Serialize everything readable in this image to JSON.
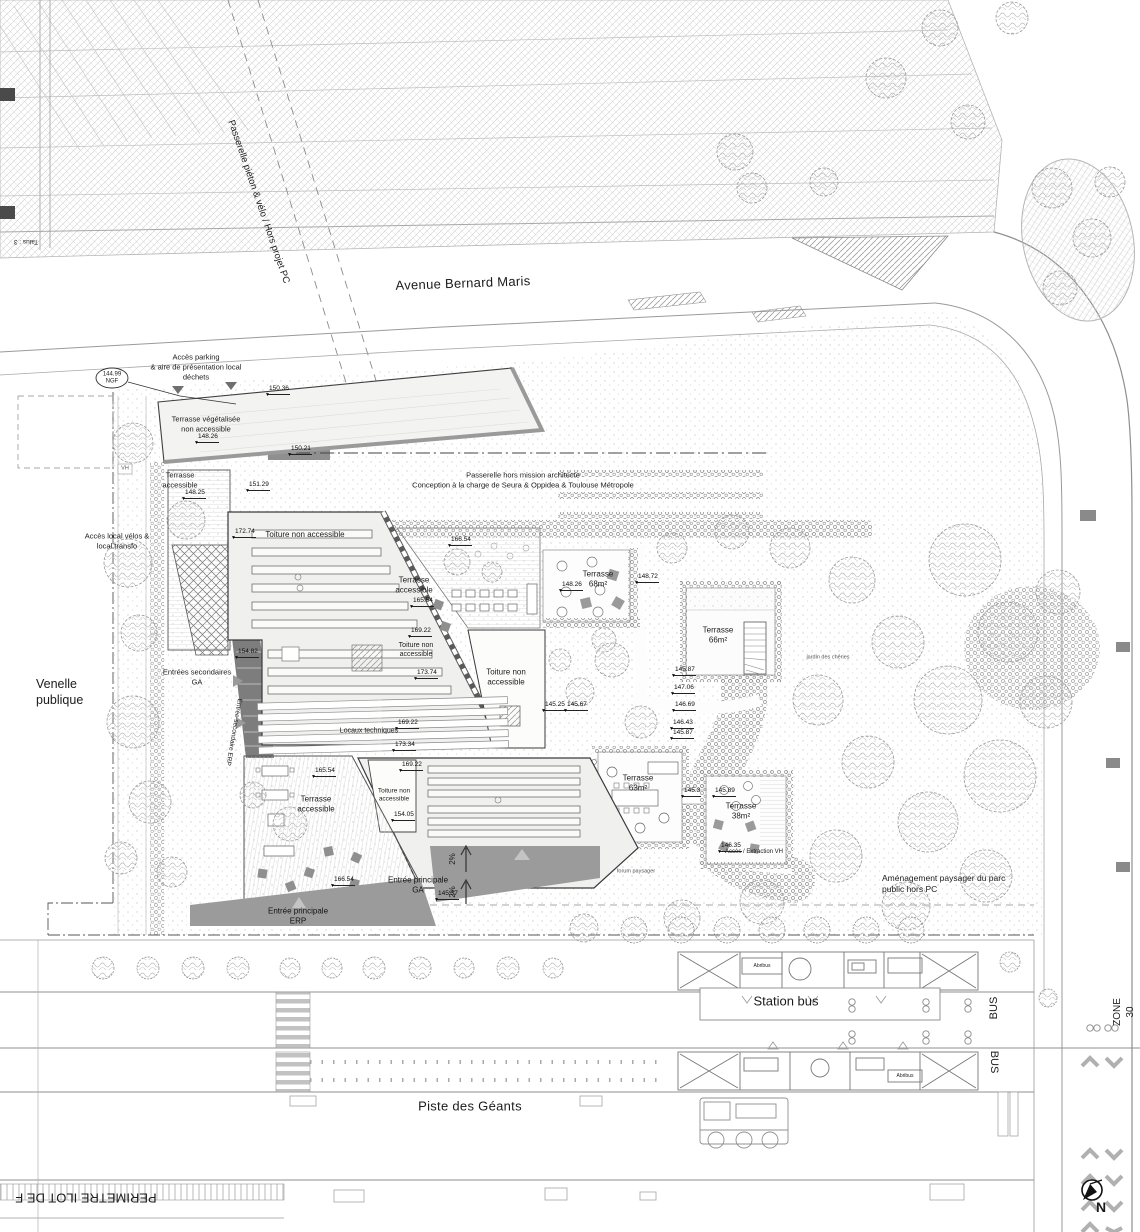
{
  "plan": {
    "streets": {
      "avenue": "Avenue Bernard Maris",
      "piste": "Piste des Géants",
      "venelle": "Venelle\npublique",
      "zone30": "ZONE 30",
      "bus1": "BUS",
      "bus2": "BUS",
      "station_bus": "Station bus",
      "talus": "Talus : 3"
    },
    "annotations": {
      "passerelle_pieton": "Passerelle piéton & vélo / Hors projet PC",
      "acces_parking": "Accès parking\n& aire de présentation local\ndéchets",
      "ngf": "144.99\nNGF",
      "passerelle_mission": "Passerelle hors mission architecte\nConception à la charge de Seura & Oppidea & Toulouse Métropole",
      "acces_velos": "Accès local vélos &\nlocal transfo",
      "amenagement": "Aménagement paysager du parc\npublic hors PC",
      "perimetre": "PERIMETRE ILOT DE F",
      "jardin": "jardin des chênes",
      "forum": "forum paysager",
      "acces_vh": "Accès / Extraction VH",
      "vh": "VH",
      "north": "N",
      "slope1": "2%",
      "slope2": "2%"
    },
    "roofs": {
      "terrasse_vegetalisee": "Terrasse végétalisée\nnon accessible",
      "toiture1": "Toiture non accessible",
      "toiture2": "Toiture non\naccessible",
      "toiture3": "Toiture non\naccessible",
      "toiture4": "Toiture non\naccessible",
      "locaux": "Locaux techniques"
    },
    "terraces": {
      "t_acc1": "Terrasse\naccessible",
      "t_acc2": "Terrasse\naccessible",
      "t_acc3": "Terrasse\naccessible",
      "t68": "Terrasse\n68m²",
      "t66": "Terrasse\n66m²",
      "t63": "Terrasse\n63m²",
      "t38": "Terrasse\n38m²"
    },
    "entrances": {
      "principale_ga": "Entrée principale\nGA",
      "principale_erp": "Entrée principale\nERP",
      "secondaires_ga": "Entrées secondaires\nGA",
      "secondaire_erp": "Entrée secondaire ERP"
    },
    "transit": {
      "abribus1": "Abribus",
      "abribus2": "Abribus"
    },
    "spots": [
      "150.36",
      "150.21",
      "151.29",
      "148.25",
      "148.26",
      "172.74",
      "166.54",
      "165.54",
      "154.82",
      "169.22",
      "173.74",
      "169.22",
      "173.34",
      "145.25",
      "145.67",
      "148.26",
      "148.72",
      "145.87",
      "147.06",
      "146.69",
      "146.43",
      "145.87",
      "145.3",
      "145.89",
      "146.35",
      "169.22",
      "154.05",
      "165.54",
      "166.54",
      "145.37"
    ]
  }
}
